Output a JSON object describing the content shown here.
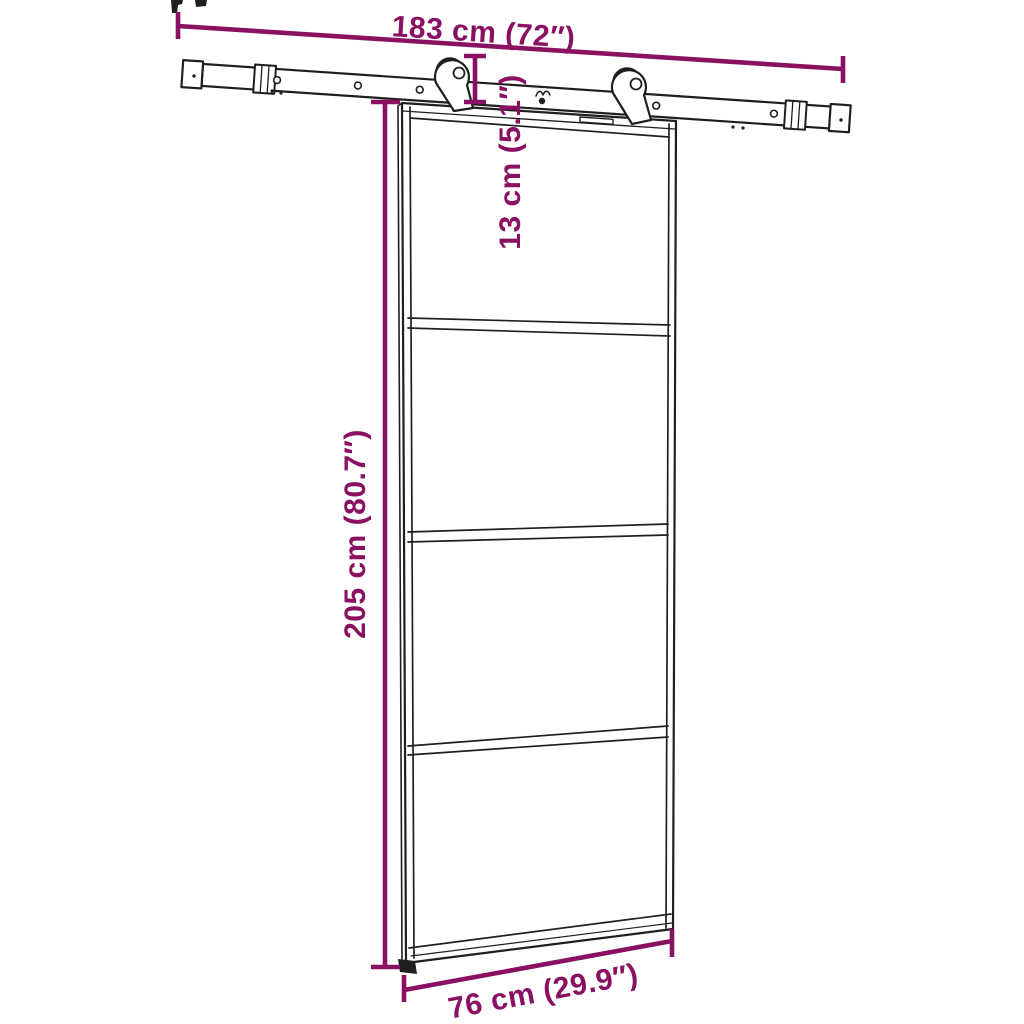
{
  "colors": {
    "dimension_accent": "#8A1062",
    "drawing_line": "#1F1F1F",
    "background": "#FFFFFF"
  },
  "dimensions": {
    "track_width": "183 cm (72″)",
    "drop_height": "13 cm (5.1″)",
    "door_height": "205 cm (80.7″)",
    "door_width": "76 cm (29.9″)"
  }
}
